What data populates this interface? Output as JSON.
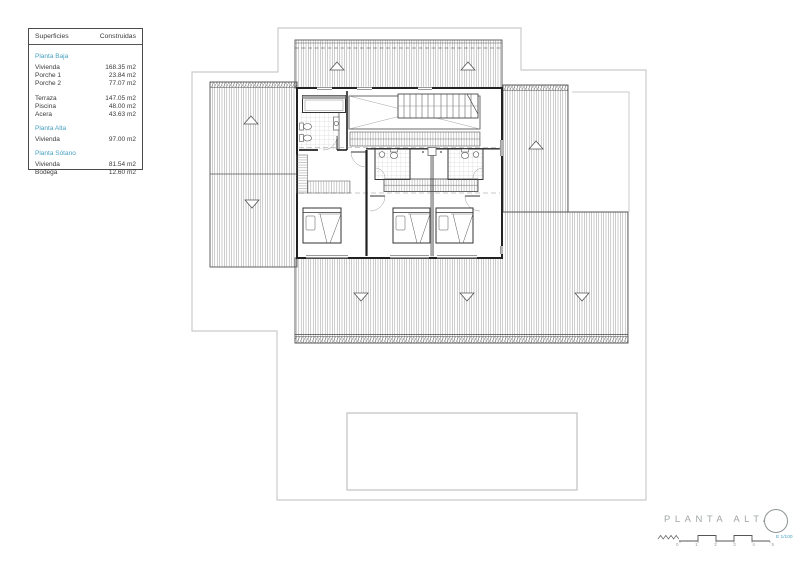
{
  "colors": {
    "accent": "#4aa0c2",
    "title-gray": "#a2a7a9",
    "boundary": "#cbcbcb",
    "ink": "#3a3a3a"
  },
  "legend": {
    "header": {
      "col1": "Superficies",
      "col2": "Construidas"
    },
    "sections": [
      {
        "title": "Planta Baja",
        "rows": [
          {
            "label": "Vivienda",
            "value": "168.35 m2"
          },
          {
            "label": "Porche 1",
            "value": "23.84 m2"
          },
          {
            "label": "Porche 2",
            "value": "77.07 m2"
          },
          {
            "label": "Terraza",
            "value": "147.05 m2"
          },
          {
            "label": "Piscina",
            "value": "48.00 m2"
          },
          {
            "label": "Acera",
            "value": "43.63 m2"
          }
        ]
      },
      {
        "title": "Planta Alta",
        "rows": [
          {
            "label": "Vivienda",
            "value": "97.00 m2"
          }
        ]
      },
      {
        "title": "Planta Sótano",
        "rows": [
          {
            "label": "Vivienda",
            "value": "81.54 m2"
          },
          {
            "label": "Bodega",
            "value": "12.60 m2"
          }
        ]
      }
    ]
  },
  "title_block": {
    "title": "PLANTA ALTA",
    "scale_label": "E 1/100",
    "ticks": [
      "0",
      "1",
      "2",
      "3",
      "4",
      "5"
    ]
  }
}
